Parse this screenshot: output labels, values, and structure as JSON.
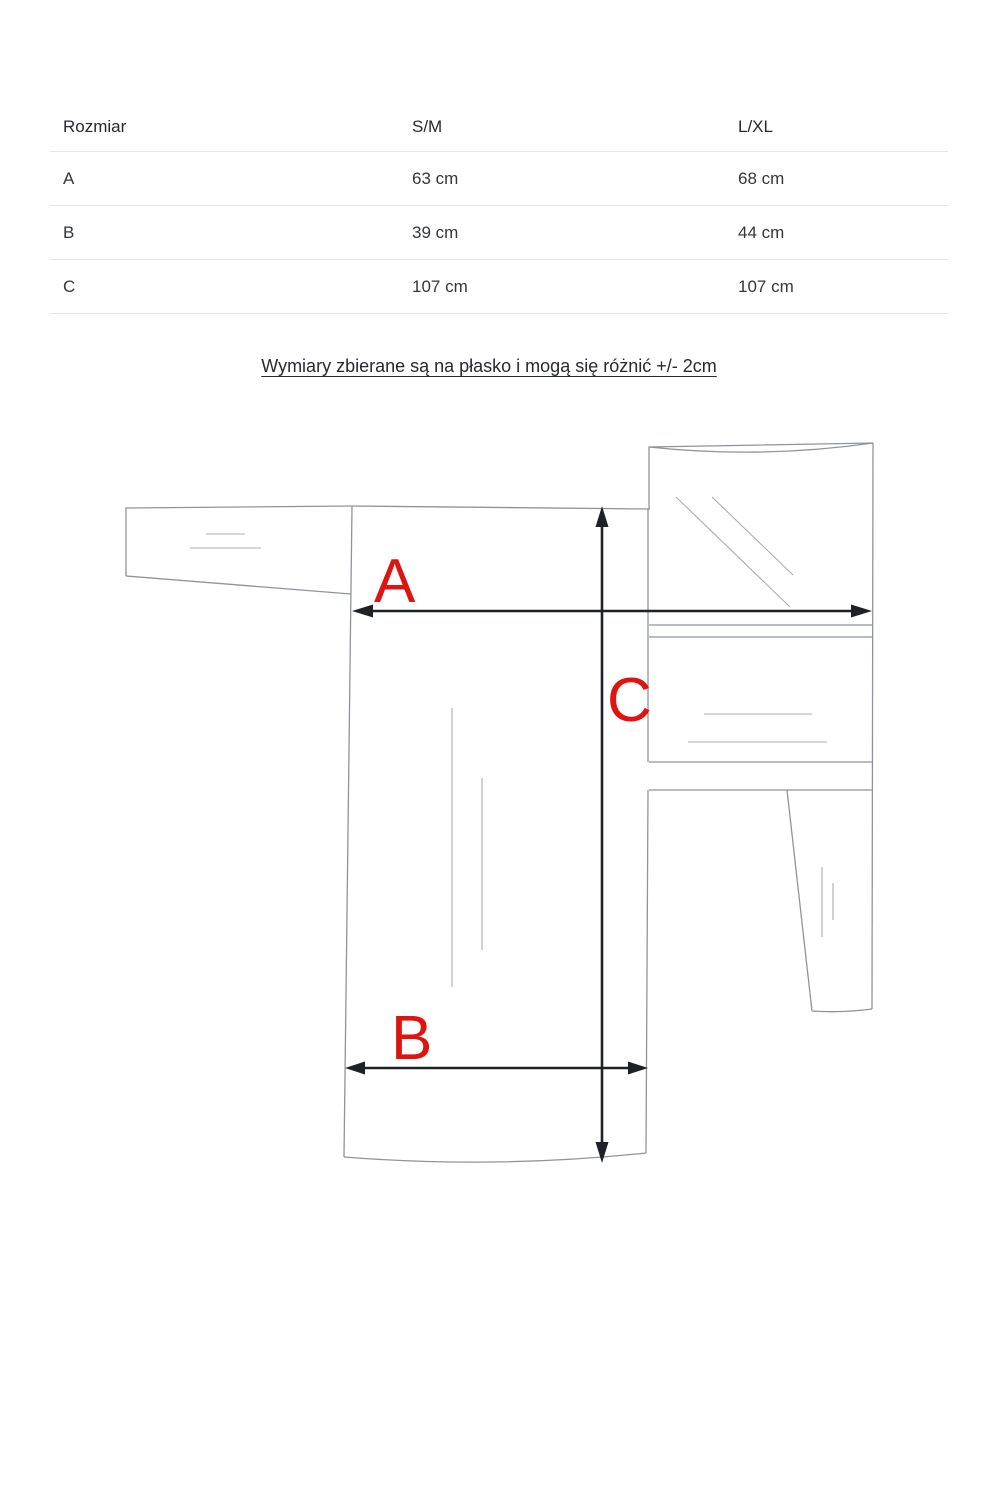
{
  "table": {
    "columns": [
      "Rozmiar",
      "S/M",
      "L/XL"
    ],
    "rows": [
      {
        "label": "A",
        "sm": "63 cm",
        "lxl": "68 cm"
      },
      {
        "label": "B",
        "sm": "39 cm",
        "lxl": "44 cm"
      },
      {
        "label": "C",
        "sm": "107 cm",
        "lxl": "107 cm"
      }
    ]
  },
  "note": {
    "text": "Wymiary zbierane są na płasko i mogą się różnić +/- 2cm"
  },
  "diagram": {
    "labels": {
      "a": "A",
      "b": "B",
      "c": "C"
    },
    "label_color": "#de1410",
    "outline_color": "#8f949c",
    "arrow_color": "#1e2126"
  }
}
